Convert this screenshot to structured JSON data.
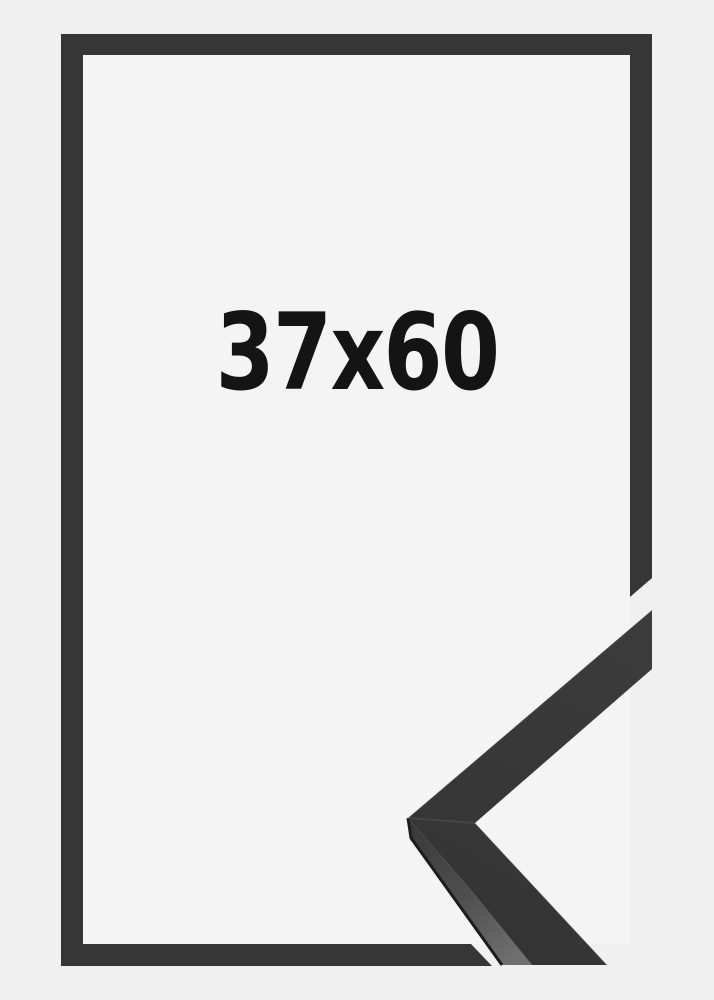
{
  "frame_product_image": {
    "size_label": "37x60",
    "colors": {
      "background": "#f0f0f1",
      "frame_interior": "#f4f4f5",
      "frame_outline": "#363636",
      "label_text": "#141414",
      "corner_sample_top_face": "#3c3c3c",
      "corner_sample_top_face_dark": "#333333",
      "corner_sample_side_face_top": "#383838",
      "corner_sample_side_face_mid": "#4f4f4f",
      "corner_sample_side_face_bottom": "#6f6f6f",
      "corner_sample_outer_rim": "#1d1d1d"
    }
  }
}
